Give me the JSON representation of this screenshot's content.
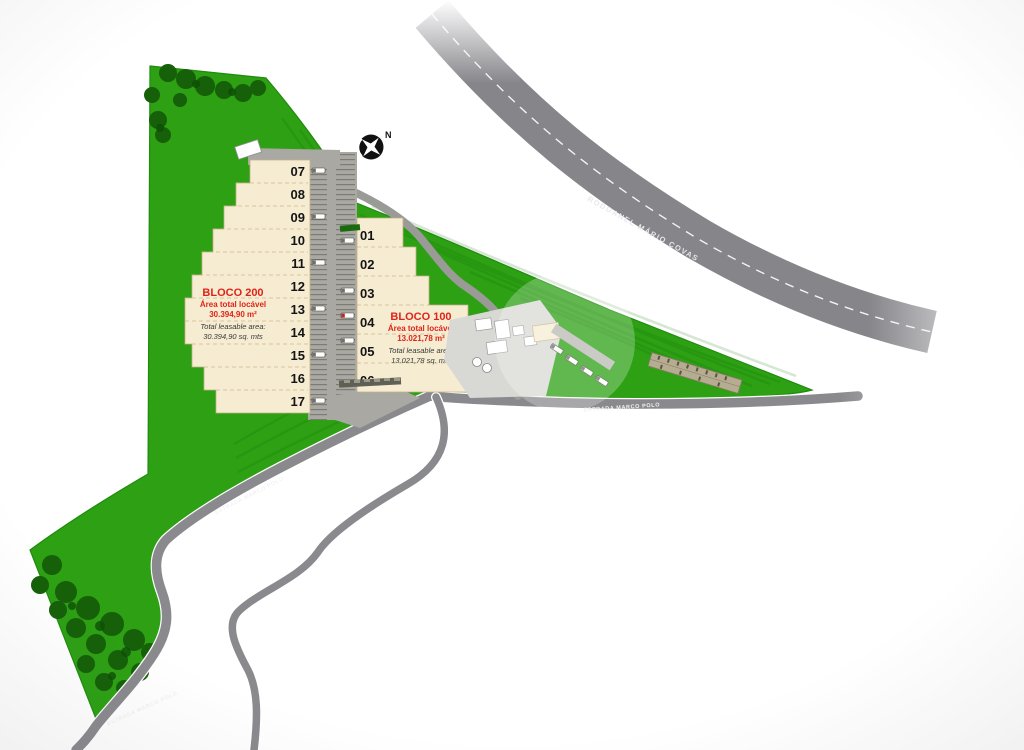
{
  "site": {
    "compass": {
      "north_label": "N"
    },
    "blocks": {
      "b200": {
        "name": "BLOCO 200",
        "area_label_pt": "Área total locável",
        "area_value_pt": "30.394,90 m²",
        "area_label_en": "Total leasable area:",
        "area_value_en": "30.394,90 sq. mts",
        "units": [
          "07",
          "08",
          "09",
          "10",
          "11",
          "12",
          "13",
          "14",
          "15",
          "16",
          "17"
        ]
      },
      "b100": {
        "name": "BLOCO 100",
        "area_label_pt": "Área total locável",
        "area_value_pt": "13.021,78 m²",
        "area_label_en": "Total leasable area:",
        "area_value_en": "13.021,78 sq. mts",
        "units": [
          "01",
          "02",
          "03",
          "04",
          "05",
          "06"
        ]
      }
    },
    "roads": {
      "rodoanel": "RODOANEL MÁRIO COVAS",
      "estrada_mid": "ESTRADA MARCO POLO",
      "estrada_left": "ESTRADA MARCO POLO",
      "estrada_bottom": "ESTRADA MARCO POLO"
    },
    "colors": {
      "grass": "#2da014",
      "tree": "#156008",
      "road_gray": "#8a8a8e",
      "warehouse_cream": "#f6ecd2",
      "dock_gray": "#a9a8a2",
      "accent_red": "#e02318"
    }
  }
}
